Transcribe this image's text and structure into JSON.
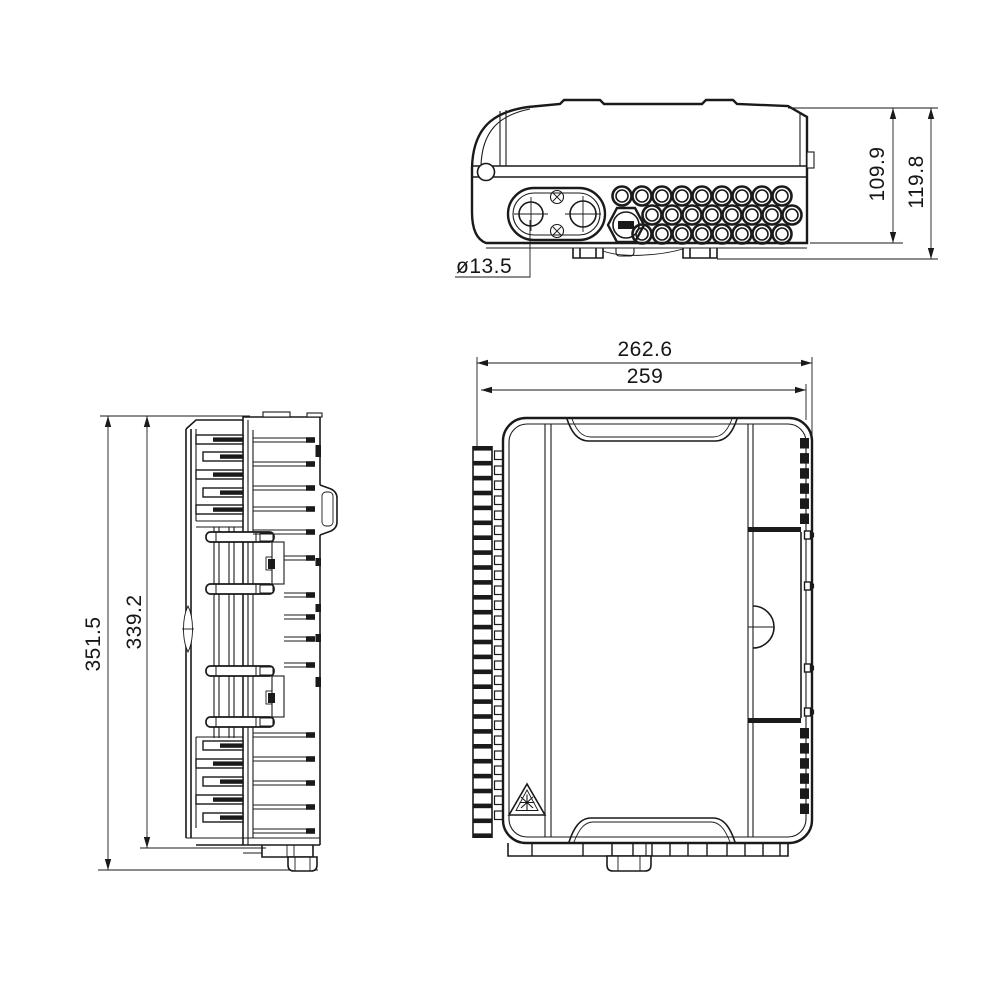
{
  "drawing": {
    "background_color": "#ffffff",
    "line_color": "#1a1a1a",
    "dims": {
      "top_body_height": "109.9",
      "top_overall_height": "119.8",
      "entry_hole_diameter": "ø13.5",
      "front_overall_width": "262.6",
      "front_body_width": "259",
      "side_overall_height": "351.5",
      "side_body_height": "339.2"
    }
  }
}
